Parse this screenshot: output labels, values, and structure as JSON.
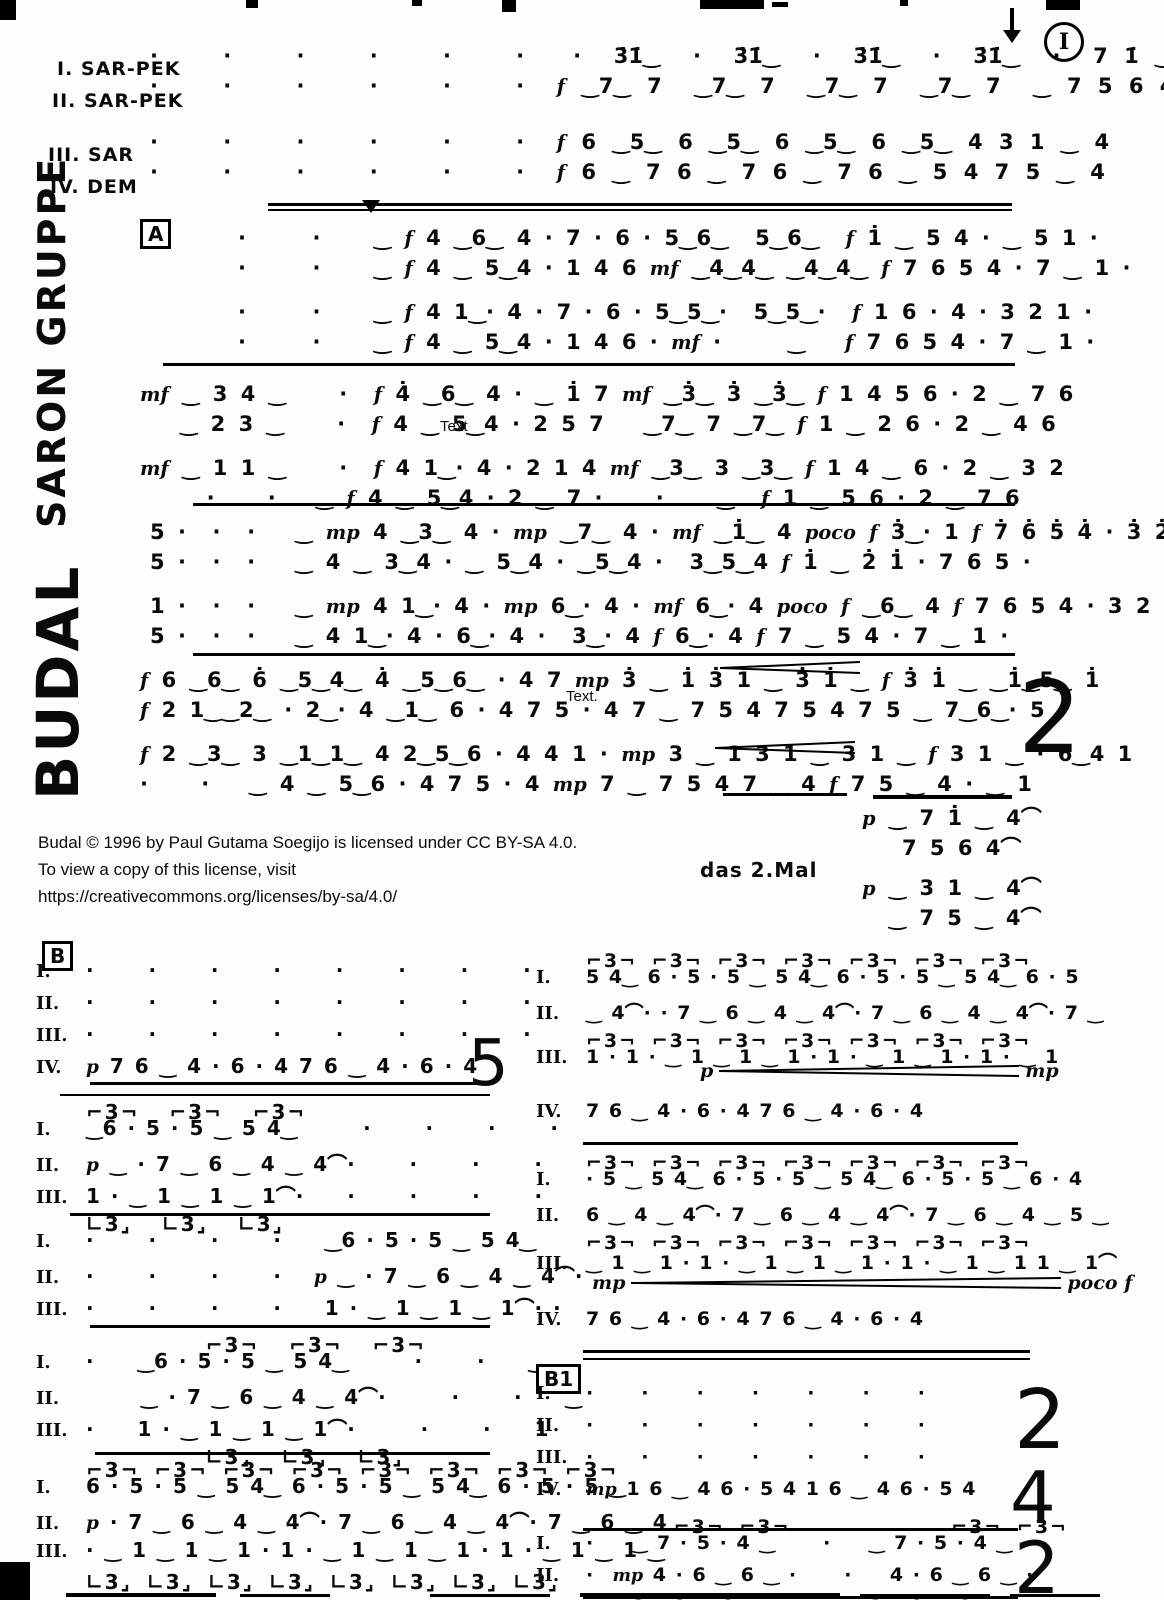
{
  "titles": {
    "main": "BUDAL",
    "sub": "SARON GRUPPE"
  },
  "topright": {
    "circle": "I"
  },
  "header": {
    "parts": [
      {
        "label": "I. SAR-PEK"
      },
      {
        "label": "II. SAR-PEK"
      },
      {
        "label": "III. SAR"
      },
      {
        "label": "IV. DEM"
      }
    ],
    "rows": [
      {
        "text": "·    ·    ·    ·    ·    ·   ·  3̇1̇‿  ·  3̇1̇‿  ·  3̇1̇‿  ·  3̇1̇‿  ·  7 1̇ ‿ 4"
      },
      {
        "text": "·    ·    ·    ·    ·    ·  f ‿7‿ 7  ‿7‿ 7  ‿7‿ 7  ‿7‿ 7  ‿ 7 5 6 4"
      },
      {
        "text": "·    ·    ·    ·    ·    ·  f 6 ‿5‿ 6 ‿5‿ 6 ‿5‿ 6 ‿5‿ 4 3 1 ‿ 4"
      },
      {
        "text": "·    ·    ·    ·    ·    ·  f 6 ‿ 7 6 ‿ 7 6 ‿ 7 6 ‿ 5 4 7 5 ‿ 4"
      }
    ]
  },
  "sectionA": {
    "label": "A",
    "repeat": "2",
    "sys1": {
      "rows": [
        {
          "text": "·     ·    ‿ f 4 ‿6‿ 4 · 7 · 6 · 5‿6‿  5‿6‿  f 1̇ ‿ 5 4 · ‿ 5 1 ·"
        },
        {
          "text": "·     ·    ‿ f 4 ‿ 5‿4 · 1 4 6 mf ‿4‿4‿ ‿4‿4‿ f 7 6 5 4 · 7 ‿ 1 ·"
        },
        {
          "text": "·     ·    ‿ f 4 1‿· 4 · 7 · 6 · 5‿5‿·  5‿5‿·  f 1 6 · 4 · 3 2 1 ·"
        },
        {
          "text": "·     ·    ‿ f 4 ‿ 5‿4 · 1 4 6 · mf ·     ‿   f 7 6 5 4 · 7 ‿ 1 ·"
        }
      ]
    },
    "sys2": {
      "rows": [
        {
          "text": "mf ‿ 3 4 ‿    ·  f 4̇ ‿6‿ 4 · ‿ 1̇ 7 mf ‿3̇‿ 3̇ ‿3̇‿ f 1 4 5 6 · 2 ‿ 7 6"
        },
        {
          "text": "   ‿ 2 3 ‿    ·  f 4 ‿ 5‿4 · 2 5 7   ‿7‿ 7 ‿7‿ f 1 ‿ 2 6 · 2 ‿ 4 6"
        },
        {
          "text": "mf ‿ 1 1 ‿    ·  f 4 1‿· 4 · 2 1 4 mf ‿3‿ 3 ‿3‿ f 1 4 ‿ 6 · 2 ‿ 3 2"
        },
        {
          "text": "     ·    ·   ‿ f 4 ‿ 5‿4 · 2 ‿ 7 ·    ·    ‿  f 1 ‿ 5 6 · 2 ‿ 7 6"
        }
      ]
    },
    "sys3": {
      "rows": [
        {
          "text": "5 ·  ·  ·   ‿ mp 4 ‿3‿ 4 · mp ‿7‿ 4 · mf ‿1̇‿ 4 poco f 3̇‿· 1 f 7̇ 6̇ 5̇ 4̇ · 3̇ 2̇ 1̇ ·"
        },
        {
          "text": "5 ·  ·  ·   ‿ 4 ‿ 3‿4 · ‿ 5‿4 · ‿5‿4 ·  3‿5‿4 f 1̇ ‿ 2̇ 1̇ · 7 6 5 ·"
        },
        {
          "text": "1 ·  ·  ·   ‿ mp 4 1‿· 4 · mp 6‿· 4 · mf 6‿· 4 poco f ‿6‿ 4 f 7 6 5 4 · 3 2 1 ·"
        },
        {
          "text": "5 ·  ·  ·   ‿ 4 1‿· 4 · 6‿· 4 ·  3‿· 4 f 6‿· 4 f 7 ‿ 5 4 · 7 ‿ 1 ·"
        }
      ]
    },
    "sys4": {
      "rows": [
        {
          "text": "f 6 ‿6‿ 6̇ ‿5‿4‿ 4̇ ‿5‿6‿ · 4 7 mp 3̇ ‿ 1̇ 3̇ 1̇ ‿ 3̇ 1̇ ‿ f 3̇ 1̇ ‿ ‿1̇‿5‿ 1̇"
        },
        {
          "text": "f 2 1‿‿2‿ · 2‿· 4 ‿1‿ 6 · 4 7 5 · 4 7 ‿ 7 5 4 7 5 4 7 5 ‿ 7‿6‿· 5"
        },
        {
          "text": "f 2 ‿3‿ 3 ‿1‿1‿ 4 2‿5‿6 · 4 4 1 · mp 3 ‿ 1 3 1 ‿ 3 1 ‿ f 3 1 ‿ · 6‿4 1"
        },
        {
          "text": "·    ·   ‿ 4 ‿ 5‿6 · 4 7 5 · 4 mp 7 ‿ 7 5 4 7 ‿ 4 f 7 5 ‿ 4 · ‿ 1"
        }
      ]
    },
    "coda": {
      "rows": [
        {
          "text": "p ‿ 7 1̇ ‿ 4⌒"
        },
        {
          "text": "   7 5 6 4⌒"
        },
        {
          "text": "p ‿ 3 1 ‿ 4⌒"
        },
        {
          "text": "  ‿ 7 5 ‿ 4⌒"
        }
      ]
    }
  },
  "overlays": {
    "text1": "Text",
    "text2": "Text."
  },
  "copyright": {
    "line1": "Budal © 1996 by Paul Gutama Soegijo is licensed under CC BY-SA 4.0.",
    "line2": "To view a copy of this license, visit",
    "line3": "https://creativecommons.org/licenses/by-sa/4.0/"
  },
  "misc": {
    "das2mal": "das 2.Mal"
  },
  "sectionB": {
    "label": "B",
    "l1": {
      "repeat": "5",
      "rows": [
        {
          "label": "I.",
          "text": "·     ·     ·     ·     ·     ·     ·     ·"
        },
        {
          "label": "II.",
          "text": "·     ·     ·     ·     ·     ·     ·     ·"
        },
        {
          "label": "III.",
          "text": "·     ·     ·     ·     ·     ·     ·     ·"
        },
        {
          "label": "IV.",
          "text": "p 7 6 ‿ 4 · 6 · 4 7 6 ‿ 4 · 6 · 4"
        }
      ]
    },
    "l2": {
      "rows": [
        {
          "small": true,
          "text": "⌐3¬  ⌐3¬  ⌐3¬"
        },
        {
          "label": "I.",
          "text": "‿6 · 5 · 5 ‿ 5 4‿      ·     ·     ·     ·"
        },
        {
          "label": "II.",
          "text": "p ‿ · 7 ‿ 6 ‿ 4 ‿ 4⌒·     ·     ·     ·"
        },
        {
          "label": "III.",
          "text": "1 · ‿ 1 ‿ 1 ‿ 1⌒·    ·     ·     ·     ·"
        },
        {
          "small": true,
          "text": "∟3⌟  ∟3⌟  ∟3⌟"
        }
      ]
    },
    "l3": {
      "rows": [
        {
          "label": "I.",
          "text": "·     ·     ·     ·    ‿6 · 5 · 5 ‿ 5 4‿"
        },
        {
          "label": "II.",
          "text": "·     ·     ·     ·   p ‿ · 7 ‿ 6 ‿ 4 ‿ 4⌒·"
        },
        {
          "label": "III.",
          "text": "·     ·     ·     ·    1 · ‿ 1 ‿ 1 ‿ 1⌒· ·"
        }
      ]
    },
    "l4": {
      "rows": [
        {
          "small": true,
          "text": "        ⌐3¬  ⌐3¬  ⌐3¬"
        },
        {
          "label": "I.",
          "text": "·    ‿6 · 5 · 5 ‿ 5 4‿      ·     ·    ‿"
        },
        {
          "label": "II.",
          "text": "     ‿ · 7 ‿ 6 ‿ 4 ‿ 4⌒·      ·     ·    ‿"
        },
        {
          "label": "III.",
          "text": "·    1 · ‿ 1 ‿ 1 ‿ 1⌒·      ·     ·    1"
        },
        {
          "small": true,
          "text": "        ∟3⌟  ∟3⌟  ∟3⌟"
        }
      ]
    },
    "l5": {
      "rows": [
        {
          "small": true,
          "text": "⌐3¬ ⌐3¬ ⌐3¬ ⌐3¬ ⌐3¬ ⌐3¬ ⌐3¬ ⌐3¬"
        },
        {
          "label": "I.",
          "text": "6 · 5 · 5 ‿ 5 4‿ 6 · 5 · 5 ‿ 5 4‿ 6 · 5 · 5 ‿"
        },
        {
          "label": "II.",
          "text": "p · 7 ‿ 6 ‿ 4 ‿ 4⌒· 7 ‿ 6 ‿ 4 ‿ 4⌒· 7 ‿ 6 ‿ 4"
        },
        {
          "label": "III.",
          "text": "· ‿ 1 ‿ 1 ‿ 1 · 1 · ‿ 1 ‿ 1 ‿ 1 · 1 · ‿ 1 ‿ 1 ‿"
        },
        {
          "small": true,
          "text": "∟3⌟ ∟3⌟ ∟3⌟ ∟3⌟ ∟3⌟ ∟3⌟ ∟3⌟ ∟3⌟"
        }
      ]
    },
    "r1": {
      "cresc": {
        "from": "p",
        "to": "mp"
      },
      "rows": [
        {
          "small": true,
          "text": "⌐3¬ ⌐3¬ ⌐3¬ ⌐3¬ ⌐3¬ ⌐3¬ ⌐3¬"
        },
        {
          "label": "I.",
          "text": "5 4‿ 6 · 5 · 5 ‿ 5 4‿ 6 · 5 · 5 ‿ 5 4‿ 6 · 5"
        },
        {
          "label": "II.",
          "text": "‿ 4⌒· · 7 ‿ 6 ‿ 4 ‿ 4⌒· 7 ‿ 6 ‿ 4 ‿ 4⌒· 7 ‿"
        },
        {
          "small": true,
          "text": "⌐3¬ ⌐3¬ ⌐3¬ ⌐3¬ ⌐3¬ ⌐3¬ ⌐3¬"
        },
        {
          "label": "III.",
          "text": "1 · 1 · ‿ 1 ‿ 1 ‿ 1 · 1 · ‿ 1 ‿ 1 · 1 · ‿ 1"
        }
      ]
    },
    "r1iv": {
      "rows": [
        {
          "label": "IV.",
          "text": "7 6 ‿ 4 · 6 · 4 7 6 ‿ 4 · 6 · 4"
        }
      ]
    },
    "r2": {
      "cresc": {
        "from": "mp",
        "to": "poco f"
      },
      "rows": [
        {
          "small": true,
          "text": "⌐3¬ ⌐3¬ ⌐3¬ ⌐3¬ ⌐3¬ ⌐3¬ ⌐3¬"
        },
        {
          "label": "I.",
          "text": "· 5 ‿ 5 4‿ 6 · 5 · 5 ‿ 5 4‿ 6 · 5 · 5 ‿ 6 · 4"
        },
        {
          "label": "II.",
          "text": "6 ‿ 4 ‿ 4⌒· 7 ‿ 6 ‿ 4 ‿ 4⌒· 7 ‿ 6 ‿ 4 ‿ 5 ‿"
        },
        {
          "small": true,
          "text": "⌐3¬ ⌐3¬ ⌐3¬ ⌐3¬ ⌐3¬ ⌐3¬ ⌐3¬"
        },
        {
          "label": "III.",
          "text": "‿ 1 ‿ 1 · 1 · ‿ 1 ‿ 1 ‿ 1 · 1 · ‿ 1 ‿ 1 1 ‿ 1⌒"
        }
      ]
    },
    "r2iv": {
      "rows": [
        {
          "label": "IV.",
          "text": "7 6 ‿ 4 · 6 · 4 7 6 ‿ 4 · 6 · 4"
        }
      ]
    }
  },
  "sectionB1": {
    "label": "B1",
    "repeat_top": "2",
    "repeat_iv": "4",
    "rows": [
      {
        "label": "I.",
        "text": "·     ·     ·     ·     ·     ·     ·"
      },
      {
        "label": "II.",
        "text": "·     ·     ·     ·     ·     ·     ·"
      },
      {
        "label": "III.",
        "text": "·     ·     ·     ·     ·     ·     ·"
      },
      {
        "label": "IV.",
        "text": "mp 1 6 ‿ 4 6 · 5 4 1 6 ‿ 4 6 · 5 4"
      }
    ]
  },
  "last": {
    "repeat": "2",
    "rows": [
      {
        "small": true,
        "text": "      ⌐3¬ ⌐3¬           ⌐3¬ ⌐3¬"
      },
      {
        "label": "I.",
        "text": "·    ‿ 7 · 5 · 4 ‿     ·    ‿ 7 · 5 · 4 ‿"
      },
      {
        "label": "II.",
        "text": "·  mp 4 · 6 ‿ 6 ‿ ·     ·    4 · 6 ‿ 6 ‿ ·"
      },
      {
        "label": "III.",
        "text": "·    1 · 4 ‿ 4 · ‿     ·    1 · 4 ‿ 4 · ‿"
      }
    ]
  }
}
